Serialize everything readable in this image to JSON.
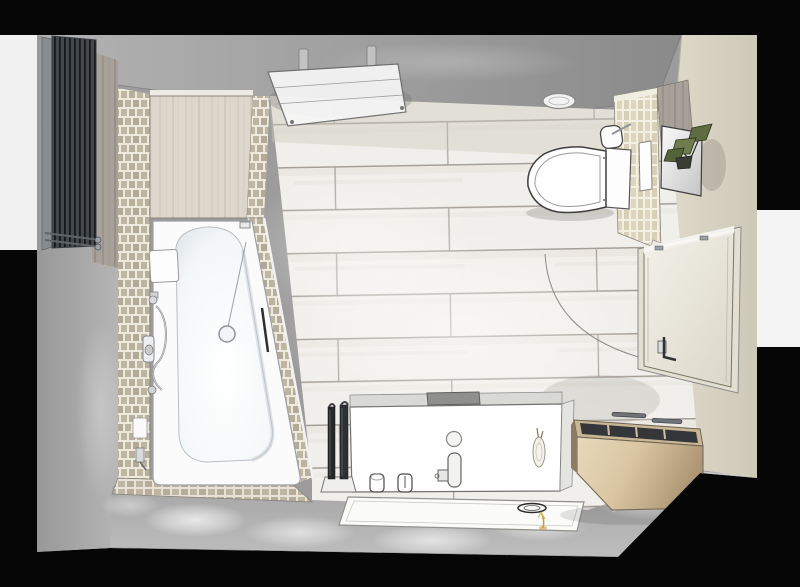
{
  "scene": {
    "title": "3D top-down rendering of a bathroom floor plan",
    "view": "perspective top view",
    "canvas_width": 800,
    "canvas_height": 587
  },
  "palette": {
    "background_black": "#060606",
    "outside_white_left": "#f1f1f1",
    "outside_white_right": "#f4f4f4",
    "room_base": "#9c9c9c",
    "ceiling_grey": "#a2a2a2",
    "left_wall_grey": "#a9a9a9",
    "bottom_floor_grey": "#b0b0b0",
    "right_wall_beige": "#d8d4c4",
    "floor_plank_light": "#f1efeb",
    "plank_joint": "#a49e96",
    "mosaic_tile": "#b7af9c",
    "mosaic_joint": "#eee9dd",
    "wood_panel_light": "#ded7cc",
    "wood_panel_grey": "#a8a199",
    "sideboard_wood": "#d3bf9f",
    "radiator_dark": "#33373a",
    "fixture_white": "#fdfdfd",
    "outline_grey": "#5a5a5a",
    "door_cream": "#efede3",
    "plant_green": "#64713f",
    "chrome": "#9ea4a8",
    "accent_gold": "#c89b3c"
  },
  "objects": {
    "room": {
      "label": "Bathroom room shell"
    },
    "ceiling": {
      "label": "Ceiling and upper wall band"
    },
    "floor": {
      "label": "Wood-look plank floor tiles"
    },
    "left_wall": {
      "label": "Left wall"
    },
    "right_wall": {
      "label": "Right wall (beige)"
    },
    "bottom_floor": {
      "label": "Grey floor strip with spot lighting"
    },
    "wood_strip": {
      "label": "Wood wall paneling strip"
    },
    "wood_column": {
      "label": "Wood wall corner panel"
    },
    "accent_wall": {
      "label": "Mosaic tiled wall at bathtub"
    },
    "enclosure": {
      "label": "Wood-panelled bath head enclosure"
    },
    "diagonal_wall": {
      "label": "Sloped mosaic bath surround wall"
    },
    "foot_deck": {
      "label": "Mosaic tiled deck at bath foot"
    },
    "radiator": {
      "label": "Vertical slatted wall radiator"
    },
    "glass_panel": {
      "label": "Wall-mounted glass panel with brackets"
    },
    "ceiling_light": {
      "label": "Oval ceiling spotlight"
    },
    "toilet": {
      "label": "Toilet with cistern, top view"
    },
    "brush_holder": {
      "label": "Toilet brush holder"
    },
    "partition": {
      "label": "Mosaic half-wall partition with niche"
    },
    "niche": {
      "label": "Recessed wall niche"
    },
    "mirror_panel": {
      "label": "Wall panel with plant shelf"
    },
    "plant": {
      "label": "Green potted plant"
    },
    "door": {
      "label": "Room door (closed)"
    },
    "door_handle": {
      "label": "Door handle"
    },
    "swing_arc": {
      "label": "Door swing arc"
    },
    "bathtub": {
      "label": "Asymmetric bathtub"
    },
    "headrest": {
      "label": "Bath headrest pad"
    },
    "drain": {
      "label": "Bathtub drain"
    },
    "grab_rail": {
      "label": "Bath grab rail"
    },
    "shower_set": {
      "label": "Shower mixer with hand shower and hose"
    },
    "soap_dish": {
      "label": "Soap dish"
    },
    "vanity": {
      "label": "Washbasin console, top view"
    },
    "faucet": {
      "label": "Basin faucet"
    },
    "basin_drain": {
      "label": "Basin drain"
    },
    "tray": {
      "label": "Countertop tray"
    },
    "tumblers": {
      "label": "Tumbler cups"
    },
    "vase": {
      "label": "Vase with twigs"
    },
    "mat": {
      "label": "Bath mat tray"
    },
    "dish_oval": {
      "label": "Oval soap dish on mat"
    },
    "gold_sprig": {
      "label": "Gold decorative sprig"
    },
    "brush_stand": {
      "label": "Bath brush set in stand"
    },
    "sideboard": {
      "label": "Open wooden sideboard with compartments"
    },
    "sideboard_handles": {
      "label": "Sideboard handle rails"
    },
    "light_pools": {
      "label": "Floor spotlight pools"
    }
  }
}
